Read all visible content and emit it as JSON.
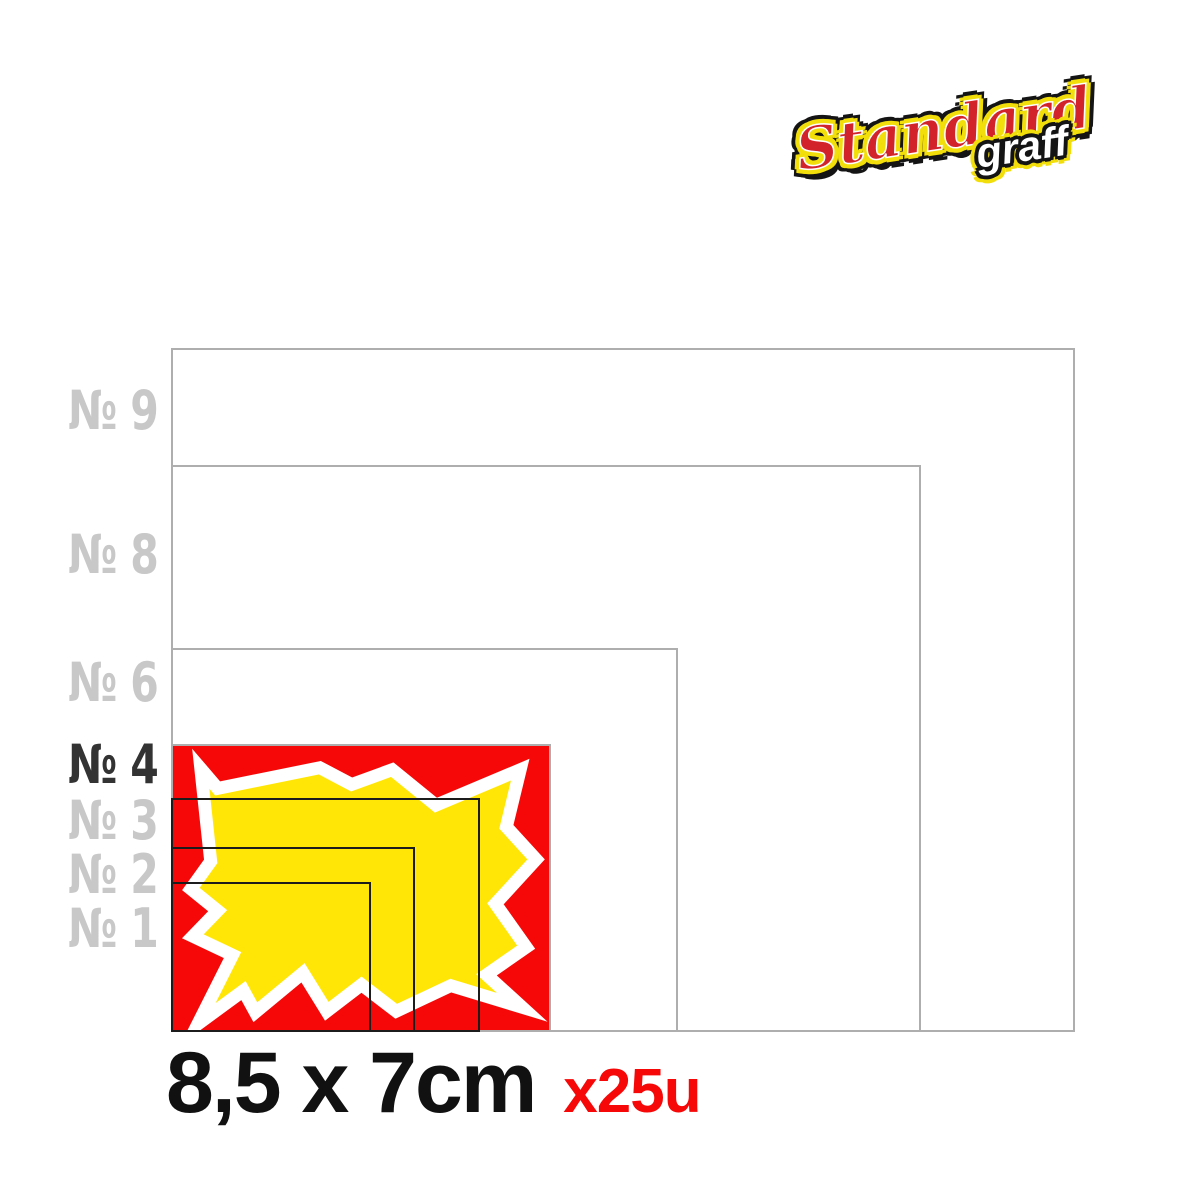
{
  "brand": {
    "primary": "Standard",
    "secondary": "graff"
  },
  "sizes": [
    {
      "label": "№ 9",
      "highlighted": false
    },
    {
      "label": "№ 8",
      "highlighted": false
    },
    {
      "label": "№ 6",
      "highlighted": false
    },
    {
      "label": "№ 4",
      "highlighted": true
    },
    {
      "label": "№ 3",
      "highlighted": false
    },
    {
      "label": "№ 2",
      "highlighted": false
    },
    {
      "label": "№ 1",
      "highlighted": false
    }
  ],
  "caption": {
    "dimensions": "8,5 x 7cm",
    "quantity": "x25u"
  },
  "colors": {
    "highlight_red": "#f60808",
    "star_yellow": "#ffe606",
    "star_outline_white": "#ffffff",
    "rect_outline_gray": "#aeaeae",
    "rect_outline_black": "#1c1c1c",
    "label_gray": "#c8c8c8",
    "label_dark": "#333333",
    "caption_black": "#111111",
    "caption_red": "#f60808",
    "logo_red": "#d2232a",
    "logo_yellow": "#f2de0a",
    "logo_black": "#141414"
  }
}
